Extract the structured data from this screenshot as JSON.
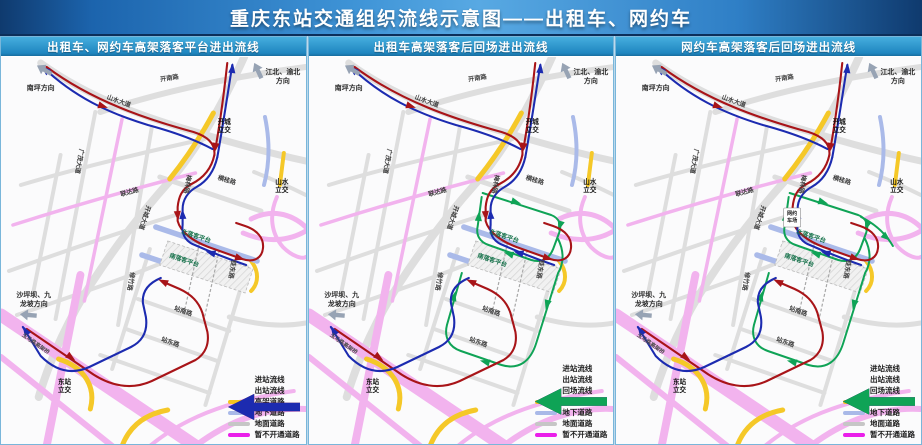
{
  "title": "重庆东站交通组织流线示意图——出租车、网约车",
  "panels": [
    {
      "header": "出租车、网约车高架落客平台进出流线",
      "show_return": false
    },
    {
      "header": "出租车高架落客后回场进出流线",
      "show_return": true
    },
    {
      "header": "网约车高架落客后回场进出流线",
      "show_return": true,
      "lot_label": [
        "网约",
        "车场"
      ]
    }
  ],
  "directions": {
    "nanping": "南坪方向",
    "jiangbei": [
      "江北、渝北",
      "方向"
    ],
    "shapingba": [
      "沙坪坝、九",
      "龙坡方向"
    ]
  },
  "roads": {
    "kainan": "开南路",
    "shanshui_ave": "山水大道",
    "kaicheng_ic": [
      "开城",
      "立交"
    ],
    "guangmao": "广茂大道",
    "lianda": "联达路",
    "kaicheng_ave": "开城大道",
    "meilin": "梅林路",
    "henggui": "横桂路",
    "shanshui_ic": [
      "山水",
      "立交"
    ],
    "north_platform": "北落客平台",
    "south_platform": "南落客平台",
    "xiuzhu": "修竹路",
    "guidong": "桂东路",
    "zhannan": "站南路",
    "zhandong": "站东路",
    "yuma": "玉马路高架桥",
    "dongzhan_ic": [
      "东站",
      "立交"
    ]
  },
  "legend": {
    "flows": [
      {
        "label": "进站流线",
        "color": "#a81418",
        "return_only": false
      },
      {
        "label": "出站流线",
        "color": "#1c2bb0",
        "return_only": false
      },
      {
        "label": "回场流线",
        "color": "#0fa356",
        "return_only": true
      }
    ],
    "roads": [
      {
        "label": "高架道路",
        "color": "#f5c41e"
      },
      {
        "label": "地下道路",
        "color": "#a9b9e8"
      },
      {
        "label": "地面道路",
        "color": "#c6c6c6"
      },
      {
        "label": "暂不开通道路",
        "color": "#ea1fea"
      }
    ]
  }
}
